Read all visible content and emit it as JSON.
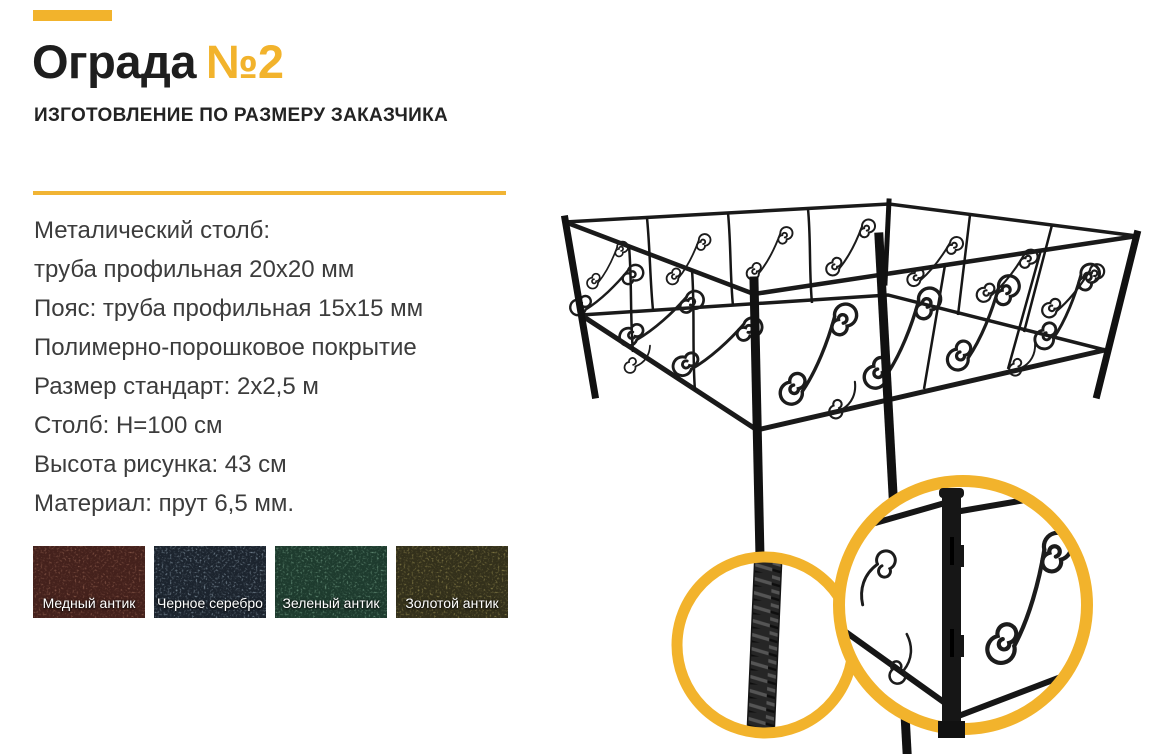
{
  "accent_color": "#F2B32C",
  "page_background": "#FFFFFF",
  "header": {
    "title_main": "Ограда",
    "title_number": "№2",
    "subtitle": "ИЗГОТОВЛЕНИЕ ПО РАЗМЕРУ ЗАКАЗЧИКА"
  },
  "specs": {
    "lines": [
      "Металический столб:",
      "труба профильная 20х20 мм",
      "Пояс: труба профильная 15х15 мм",
      "Полимерно-порошковое покрытие",
      "Размер стандарт: 2х2,5 м",
      "Столб: Н=100 см",
      "Высота рисунка: 43 см",
      "Материал: прут 6,5 мм."
    ]
  },
  "swatches": [
    {
      "label": "Медный антик",
      "base": "#44211C",
      "speckle": "#A5705C"
    },
    {
      "label": "Черное серебро",
      "base": "#1C242E",
      "speckle": "#A8BCCB"
    },
    {
      "label": "Зеленый антик",
      "base": "#1E3B2E",
      "speckle": "#86B59A"
    },
    {
      "label": "Золотой антик",
      "base": "#33301B",
      "speckle": "#ACA05B"
    }
  ],
  "illustration": {
    "metal_color": "#1B1B1B",
    "zoom_ring_color": "#F2B32C"
  }
}
